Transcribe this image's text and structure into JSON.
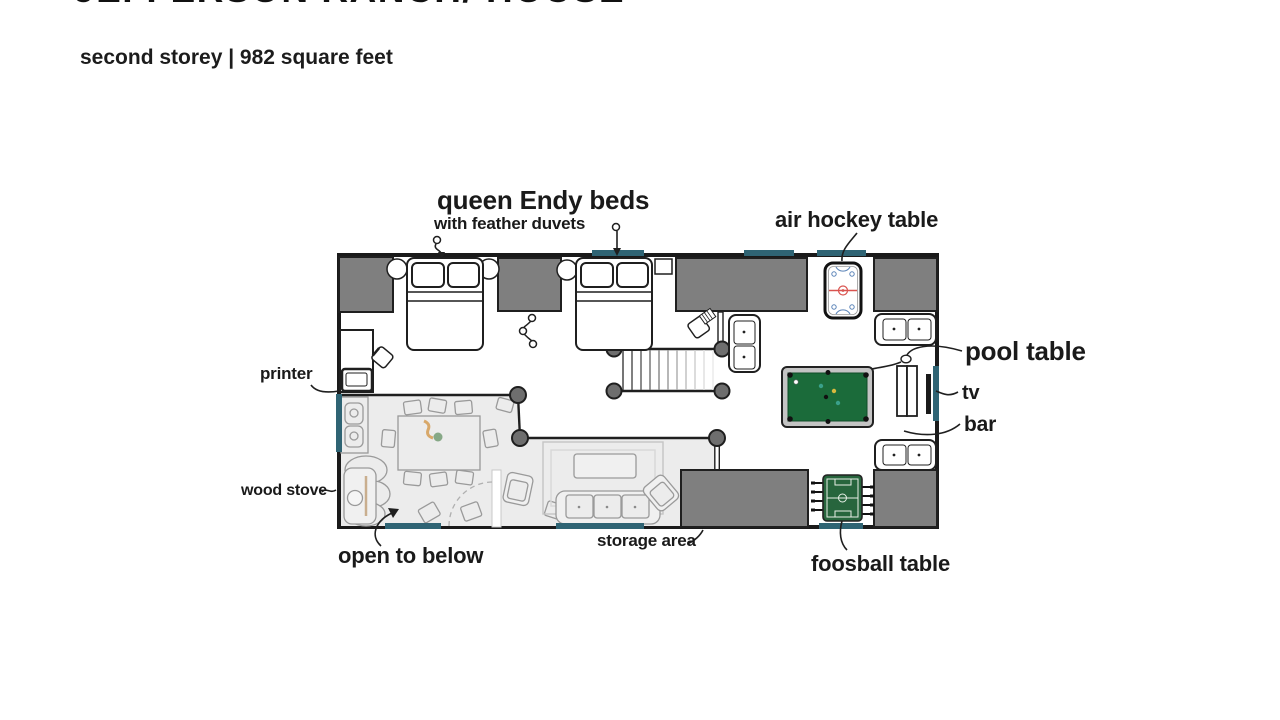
{
  "header": {
    "title": "JEFFERSON RANCH/ HOUSE",
    "subtitle": "second storey | 982 square feet"
  },
  "plan": {
    "labels": {
      "beds_title": "queen Endy beds",
      "beds_subtitle": "with feather duvets",
      "air_hockey": "air hockey table",
      "pool_table": "pool table",
      "tv": "tv",
      "bar": "bar",
      "printer": "printer",
      "wood_stove": "wood stove",
      "open_to_below": "open to below",
      "storage_area": "storage area",
      "foosball": "foosball table"
    },
    "colors": {
      "wall": "#1a1a1a",
      "closet_fill": "#7f7f7f",
      "window": "#2f6474",
      "open_below_fill": "#ececec",
      "below_stroke": "#9a9a9a",
      "post_fill": "#6e6e6e",
      "pool_felt": "#1b6b3a",
      "foosball_felt": "#27653d",
      "hockey_red": "#d9534f",
      "hockey_blue": "#5b84b8"
    }
  }
}
